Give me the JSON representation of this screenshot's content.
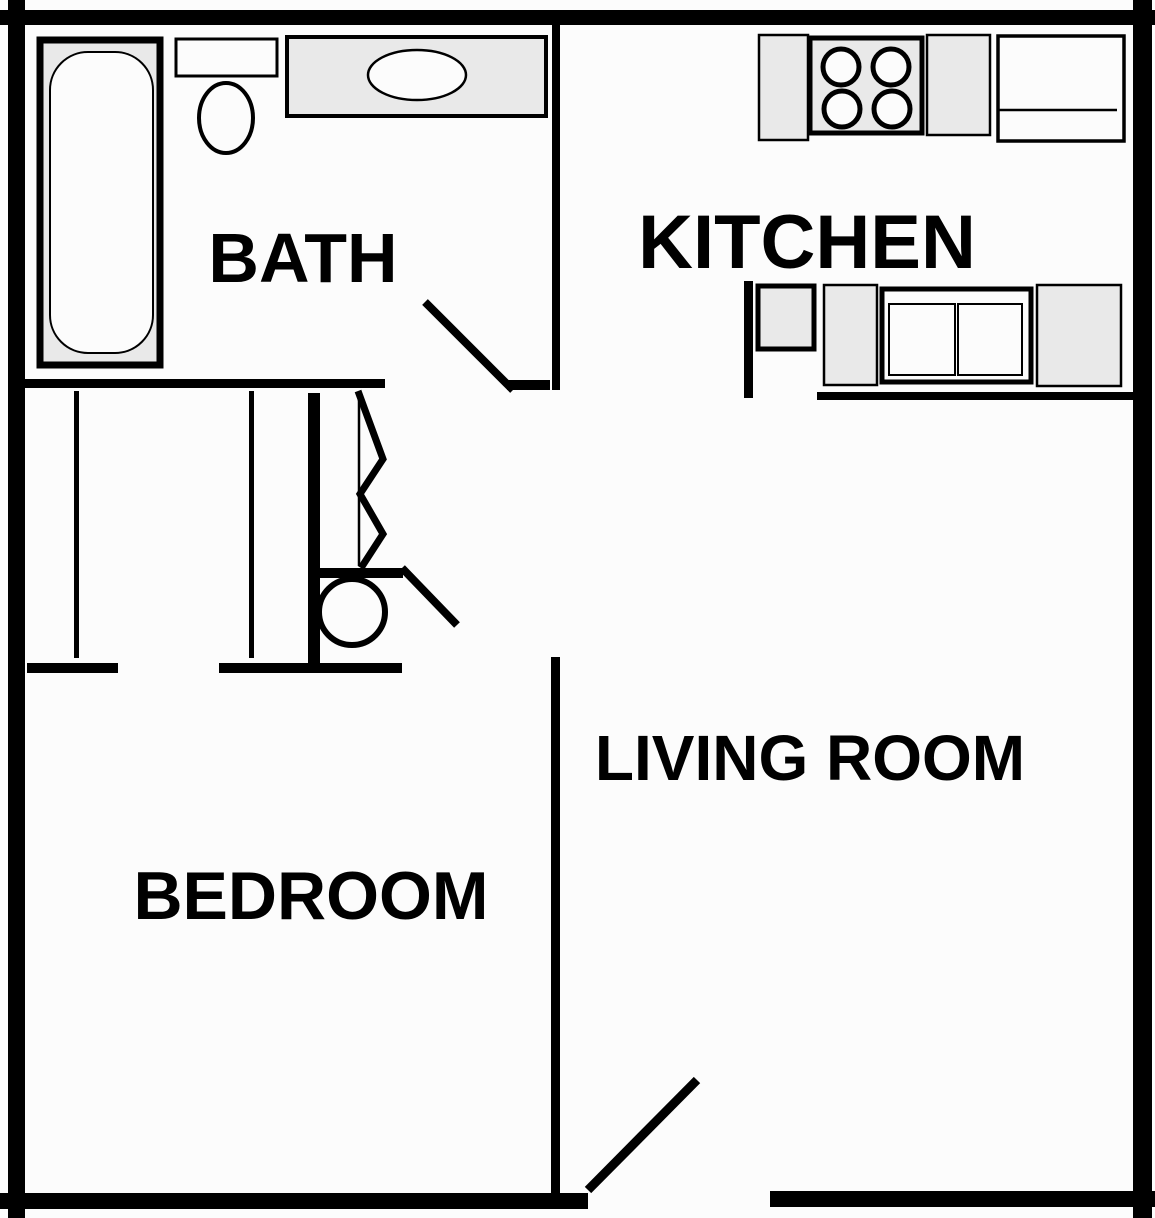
{
  "title": "One-Bedroom Apartment Floor Plan",
  "colors": {
    "background": "#fcfcfc",
    "wall": "#000000",
    "fixture_fill": "#e9e9e9"
  },
  "rooms": {
    "bath": {
      "label": "BATH"
    },
    "kitchen": {
      "label": "KITCHEN"
    },
    "bedroom": {
      "label": "BEDROOM"
    },
    "living_room": {
      "label": "LIVING ROOM"
    }
  },
  "fixtures": [
    "bathtub",
    "toilet",
    "vanity-sink",
    "cooktop-stove",
    "refrigerator",
    "kitchen-counter",
    "double-basin-sink",
    "water-heater",
    "bifold-closet-door",
    "hinged-door-swing"
  ]
}
